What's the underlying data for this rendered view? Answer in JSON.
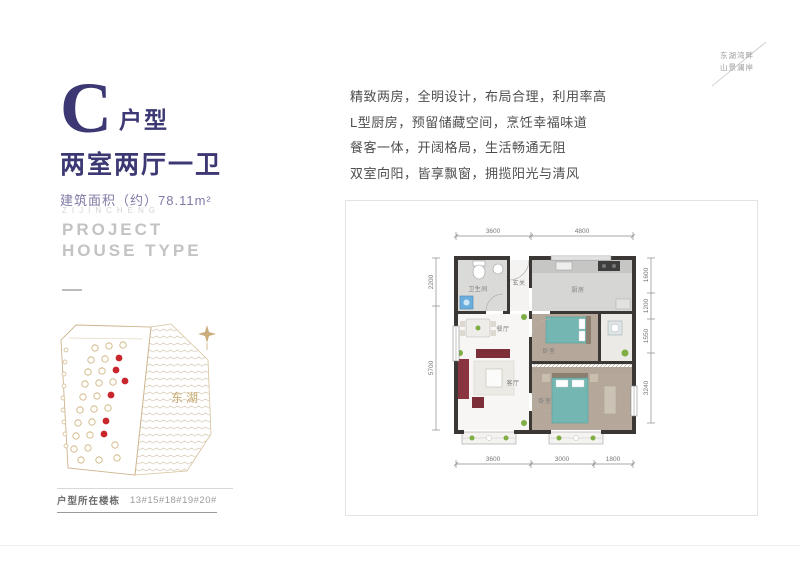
{
  "hero": {
    "type_letter": "C",
    "type_suffix": "户型",
    "layout_title": "两室两厅一卫",
    "area_text": "建筑面积（约）78.11m²",
    "accent_color": "#3c3874"
  },
  "english_block": {
    "line1": "ZIJINCHENG",
    "line2": "PROJECT",
    "line3": "HOUSE TYPE"
  },
  "tagline": {
    "line1": "东湖湾畔",
    "line2": "山景澜岸"
  },
  "features": [
    "精致两房，全明设计，布局合理，利用率高",
    "L型厨房，预留储藏空间，烹饪幸福味道",
    "餐客一体，开阔格局，生活畅通无阻",
    "双室向阳，皆享飘窗，拥揽阳光与清风"
  ],
  "sitemap": {
    "lake_label": "东湖",
    "outline_color": "#c9ad7a",
    "marker_color": "#c8262c"
  },
  "footer": {
    "label": "户型所在楼栋",
    "buildings": "13#15#18#19#20#"
  },
  "floorplan": {
    "rooms": {
      "bath": "卫生间",
      "foyer": "玄关",
      "kitchen": "厨房",
      "dining": "餐厅",
      "living": "客厅",
      "bedroom1": "卧室",
      "bedroom2": "卧室"
    },
    "dims": {
      "top": [
        "3600",
        "4800"
      ],
      "bottom": [
        "3600",
        "3000",
        "1800"
      ],
      "left": [
        "2200",
        "5700"
      ],
      "right": [
        "1600",
        "1200",
        "1550",
        "3240"
      ]
    }
  }
}
